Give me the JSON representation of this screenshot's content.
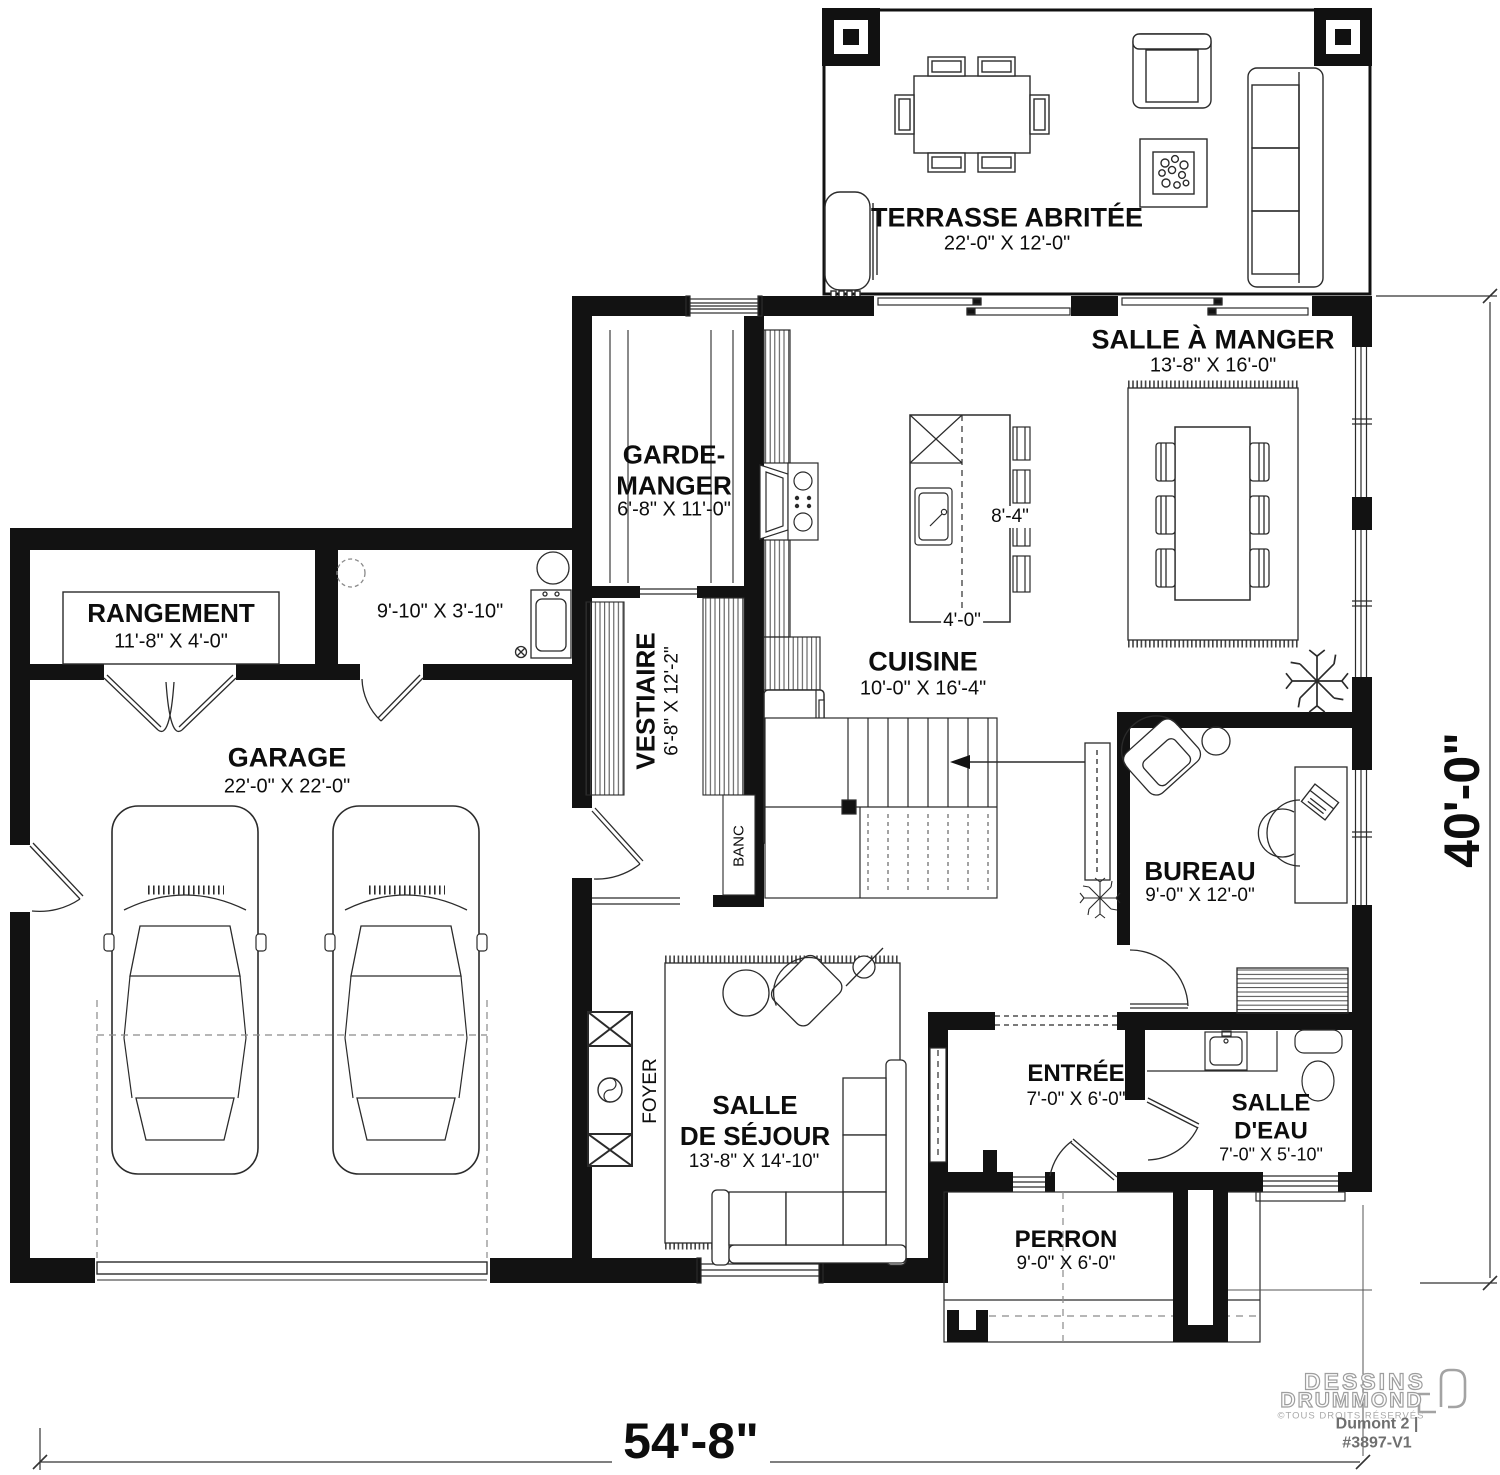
{
  "rooms": {
    "terrasse": {
      "name": "TERRASSE ABRITÉE",
      "dims": "22'-0\" X 12'-0\""
    },
    "salle_a_manger": {
      "name": "SALLE À MANGER",
      "dims": "13'-8\" X 16'-0\""
    },
    "garde_manger": {
      "name": "GARDE-\nMANGER",
      "dims": "6'-8\" X 11'-0\""
    },
    "cuisine": {
      "name": "CUISINE",
      "dims": "10'-0\" X 16'-4\""
    },
    "vestiaire": {
      "name": "VESTIAIRE",
      "dims": "6'-8\" X 12'-2\""
    },
    "rangement": {
      "name": "RANGEMENT",
      "dims": "11'-8\" X 4'-0\""
    },
    "garage": {
      "name": "GARAGE",
      "dims": "22'-0\" X 22'-0\""
    },
    "bureau": {
      "name": "BUREAU",
      "dims": "9'-0\" X 12'-0\""
    },
    "salle_de_sejour": {
      "name": "SALLE\nDE SÉJOUR",
      "dims": "13'-8\" X 14'-10\""
    },
    "entree": {
      "name": "ENTRÉE",
      "dims": "7'-0\" X 6'-0\""
    },
    "salle_deau": {
      "name": "SALLE\nD'EAU",
      "dims": "7'-0\" X 5'-10\""
    },
    "perron": {
      "name": "PERRON",
      "dims": "9'-0\" X 6'-0\""
    }
  },
  "annotations": {
    "foyer": "FOYER",
    "banc": "BANC",
    "storage_dims": "9'-10\" X 3'-10\"",
    "island_depth": "8'-4\"",
    "island_width": "4'-0\""
  },
  "overall_dimensions": {
    "width": "54'-8\"",
    "depth": "40'-0\""
  },
  "branding": {
    "line1": "DESSINS",
    "line2": "DRUMMOND",
    "rights": "©TOUS DROITS RÉSERVÉS",
    "plan_id": "Dumont 2 | #3897-V1"
  }
}
